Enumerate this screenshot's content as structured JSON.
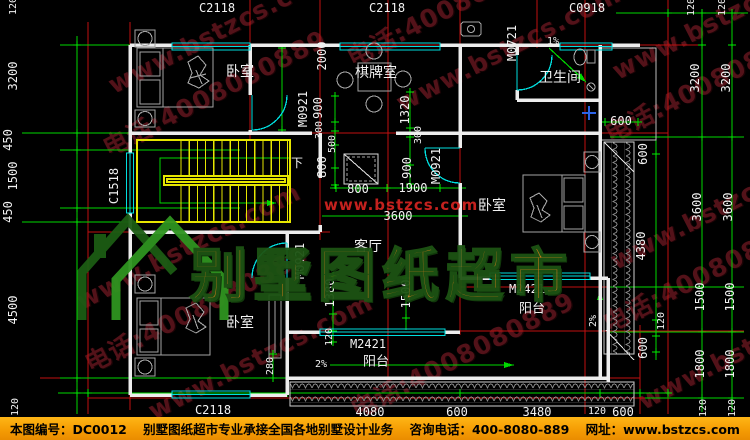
{
  "footer": {
    "sheet_no": "本图编号：DC0012",
    "service": "别墅图纸超市专业承接全国各地别墅设计业务",
    "phone": "咨询电话：400-8080-889",
    "site": "网址：www.bstzcs.com"
  },
  "logo": {
    "brand": "别墅图纸超市",
    "url": "www.bstzcs.com"
  },
  "watermark": {
    "line1": "www.bstzcs.com",
    "line2": "电话:4008080889"
  },
  "annotations": [
    {
      "t": "C2118",
      "x": 217,
      "y": 8,
      "k": "window-code"
    },
    {
      "t": "C2118",
      "x": 387,
      "y": 8,
      "k": "window-code"
    },
    {
      "t": "C0918",
      "x": 587,
      "y": 8,
      "k": "window-code"
    },
    {
      "t": "C1518",
      "x": 114,
      "y": 186,
      "r": -90,
      "k": "window-code"
    },
    {
      "t": "C2118",
      "x": 213,
      "y": 410,
      "k": "window-code"
    },
    {
      "t": "M0921",
      "x": 303,
      "y": 109,
      "r": -90,
      "k": "door-code"
    },
    {
      "t": "M0721",
      "x": 512,
      "y": 43,
      "r": -90,
      "k": "door-code"
    },
    {
      "t": "M0921",
      "x": 436,
      "y": 166,
      "r": -90,
      "k": "door-code"
    },
    {
      "t": "M0921",
      "x": 300,
      "y": 261,
      "r": -90,
      "k": "door-code"
    },
    {
      "t": "M2421",
      "x": 368,
      "y": 344,
      "k": "door-code"
    },
    {
      "t": "M2421",
      "x": 527,
      "y": 289,
      "k": "door-code"
    },
    {
      "t": "卧室",
      "x": 240,
      "y": 72,
      "s": 14,
      "k": "room-label"
    },
    {
      "t": "棋牌室",
      "x": 376,
      "y": 73,
      "s": 14,
      "k": "room-label"
    },
    {
      "t": "卫生间",
      "x": 560,
      "y": 78,
      "s": 14,
      "k": "room-label"
    },
    {
      "t": "卧室",
      "x": 492,
      "y": 206,
      "s": 14,
      "k": "room-label"
    },
    {
      "t": "客厅",
      "x": 368,
      "y": 247,
      "s": 14,
      "k": "room-label"
    },
    {
      "t": "卧室",
      "x": 240,
      "y": 323,
      "s": 14,
      "k": "room-label"
    },
    {
      "t": "阳台",
      "x": 376,
      "y": 362,
      "s": 13,
      "k": "room-label"
    },
    {
      "t": "阳台",
      "x": 532,
      "y": 309,
      "s": 13,
      "k": "room-label"
    },
    {
      "t": "下",
      "x": 297,
      "y": 163,
      "s": 12,
      "k": "stair-direction"
    },
    {
      "t": "1%",
      "x": 553,
      "y": 42,
      "s": 10,
      "k": "slope"
    },
    {
      "t": "2%",
      "x": 321,
      "y": 365,
      "s": 10,
      "k": "slope"
    },
    {
      "t": "2%",
      "x": 594,
      "y": 321,
      "r": -90,
      "s": 10,
      "k": "slope"
    },
    {
      "t": "120",
      "x": 14,
      "y": 6,
      "r": -90,
      "s": 10,
      "k": "dim"
    },
    {
      "t": "3200",
      "x": 13,
      "y": 76,
      "r": -90,
      "k": "dim"
    },
    {
      "t": "450",
      "x": 8,
      "y": 140,
      "r": -90,
      "k": "dim"
    },
    {
      "t": "1500",
      "x": 13,
      "y": 176,
      "r": -90,
      "k": "dim"
    },
    {
      "t": "450",
      "x": 8,
      "y": 212,
      "r": -90,
      "k": "dim"
    },
    {
      "t": "4500",
      "x": 13,
      "y": 310,
      "r": -90,
      "k": "dim"
    },
    {
      "t": "120",
      "x": 16,
      "y": 407,
      "r": -90,
      "s": 10,
      "k": "dim"
    },
    {
      "t": "2000",
      "x": 322,
      "y": 56,
      "r": -90,
      "k": "dim"
    },
    {
      "t": "900",
      "x": 318,
      "y": 108,
      "r": -90,
      "k": "dim"
    },
    {
      "t": "300",
      "x": 320,
      "y": 130,
      "r": -90,
      "s": 10,
      "k": "dim"
    },
    {
      "t": "500",
      "x": 333,
      "y": 144,
      "r": -90,
      "s": 10,
      "k": "dim"
    },
    {
      "t": "800",
      "x": 322,
      "y": 167,
      "r": -90,
      "k": "dim"
    },
    {
      "t": "1320",
      "x": 405,
      "y": 110,
      "r": -90,
      "k": "dim"
    },
    {
      "t": "300",
      "x": 419,
      "y": 135,
      "r": -90,
      "s": 10,
      "k": "dim"
    },
    {
      "t": "900",
      "x": 407,
      "y": 168,
      "r": -90,
      "k": "dim"
    },
    {
      "t": "800",
      "x": 358,
      "y": 189,
      "k": "dim"
    },
    {
      "t": "1900",
      "x": 413,
      "y": 188,
      "k": "dim"
    },
    {
      "t": "3600",
      "x": 398,
      "y": 216,
      "k": "dim"
    },
    {
      "t": "600",
      "x": 621,
      "y": 121,
      "k": "dim"
    },
    {
      "t": "1380",
      "x": 330,
      "y": 293,
      "r": -90,
      "k": "dim"
    },
    {
      "t": "1500",
      "x": 406,
      "y": 294,
      "r": -90,
      "k": "dim"
    },
    {
      "t": "120",
      "x": 330,
      "y": 337,
      "r": -90,
      "s": 10,
      "k": "dim"
    },
    {
      "t": "280",
      "x": 271,
      "y": 366,
      "r": -90,
      "s": 10,
      "k": "dim"
    },
    {
      "t": "600",
      "x": 643,
      "y": 154,
      "r": -90,
      "k": "dim"
    },
    {
      "t": "4380",
      "x": 641,
      "y": 246,
      "r": -90,
      "k": "dim"
    },
    {
      "t": "120",
      "x": 662,
      "y": 321,
      "r": -90,
      "s": 10,
      "k": "dim"
    },
    {
      "t": "600",
      "x": 643,
      "y": 348,
      "r": -90,
      "k": "dim"
    },
    {
      "t": "120",
      "x": 692,
      "y": 7,
      "r": -90,
      "s": 10,
      "k": "dim"
    },
    {
      "t": "120",
      "x": 723,
      "y": 7,
      "r": -90,
      "s": 10,
      "k": "dim"
    },
    {
      "t": "3200",
      "x": 695,
      "y": 78,
      "r": -90,
      "k": "dim"
    },
    {
      "t": "3600",
      "x": 697,
      "y": 207,
      "r": -90,
      "k": "dim"
    },
    {
      "t": "1500",
      "x": 700,
      "y": 297,
      "r": -90,
      "k": "dim"
    },
    {
      "t": "1800",
      "x": 700,
      "y": 364,
      "r": -90,
      "k": "dim"
    },
    {
      "t": "120",
      "x": 704,
      "y": 408,
      "r": -90,
      "s": 10,
      "k": "dim"
    },
    {
      "t": "3200",
      "x": 726,
      "y": 78,
      "r": -90,
      "k": "dim"
    },
    {
      "t": "3600",
      "x": 728,
      "y": 207,
      "r": -90,
      "k": "dim"
    },
    {
      "t": "1500",
      "x": 730,
      "y": 297,
      "r": -90,
      "k": "dim"
    },
    {
      "t": "1800",
      "x": 730,
      "y": 364,
      "r": -90,
      "k": "dim"
    },
    {
      "t": "120",
      "x": 733,
      "y": 408,
      "r": -90,
      "s": 10,
      "k": "dim"
    },
    {
      "t": "4080",
      "x": 370,
      "y": 412,
      "k": "dim"
    },
    {
      "t": "600",
      "x": 457,
      "y": 412,
      "k": "dim"
    },
    {
      "t": "3480",
      "x": 537,
      "y": 412,
      "k": "dim"
    },
    {
      "t": "120",
      "x": 597,
      "y": 412,
      "s": 10,
      "k": "dim"
    },
    {
      "t": "600",
      "x": 623,
      "y": 412,
      "k": "dim"
    }
  ]
}
